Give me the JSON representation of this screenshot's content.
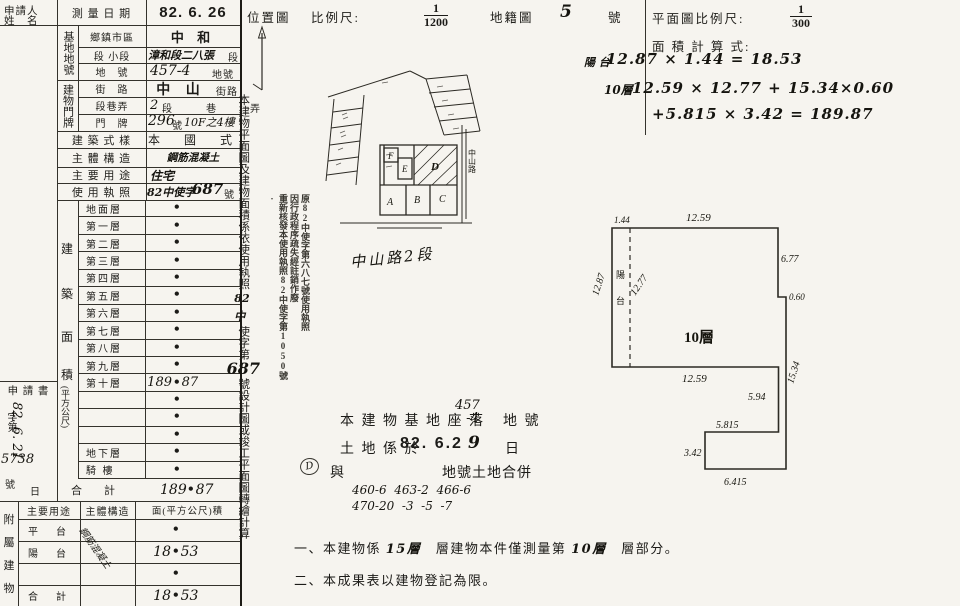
{
  "doc": {
    "bg": "#f6f4ef",
    "ink": "#1c1b18"
  },
  "left": {
    "applicant_l1": "申請人",
    "applicant_l2": "姓　名",
    "survey_label": "測 量 日 期",
    "survey_value": "82. 6. 26",
    "site_group": "基地地號",
    "site_rows": [
      {
        "label": "鄉鎮市區",
        "value": "中 和",
        "suffix": ""
      },
      {
        "label": "段 小段",
        "value": "漳和段二八張",
        "suffix": "段"
      },
      {
        "label": "地　號",
        "value": "457-4",
        "suffix": "地號"
      }
    ],
    "addr_group": "建物門牌",
    "addr_rows": [
      {
        "label": "街　路",
        "value": "中 山",
        "suffix": "街路"
      },
      {
        "label": "段巷弄",
        "value": "2",
        "suffix": "段　巷　弄"
      },
      {
        "label": "門　牌",
        "value": "296",
        "suffix": "號",
        "extra": "10F之4樓"
      }
    ],
    "style_label": "建 築 式 樣",
    "style_value": "本　國　式",
    "structure_label": "主 體 構 造",
    "structure_value": "鋼筋混凝土",
    "usage_label": "主 要 用 途",
    "usage_value": "住宅",
    "license_label": "使 用 執 照",
    "license_prefix": "82中使字",
    "license_num": "687",
    "license_suffix": "號",
    "floors": {
      "group_chars": [
        "建",
        "築",
        "面",
        "積"
      ],
      "unit": "(平方公尺)",
      "dot": "•",
      "rows": [
        {
          "label": "地面層",
          "l": "",
          "r": ""
        },
        {
          "label": "第一層",
          "l": "",
          "r": ""
        },
        {
          "label": "第二層",
          "l": "",
          "r": ""
        },
        {
          "label": "第三層",
          "l": "",
          "r": ""
        },
        {
          "label": "第四層",
          "l": "",
          "r": ""
        },
        {
          "label": "第五層",
          "l": "",
          "r": ""
        },
        {
          "label": "第六層",
          "l": "",
          "r": ""
        },
        {
          "label": "第七層",
          "l": "",
          "r": ""
        },
        {
          "label": "第八層",
          "l": "",
          "r": ""
        },
        {
          "label": "第九層",
          "l": "",
          "r": ""
        },
        {
          "label": "第十層",
          "l": "189",
          "r": "87"
        },
        {
          "label": "",
          "l": "",
          "r": ""
        },
        {
          "label": "",
          "l": "",
          "r": ""
        },
        {
          "label": "",
          "l": "",
          "r": ""
        },
        {
          "label": "地下層",
          "l": "",
          "r": ""
        },
        {
          "label": "騎 樓",
          "l": "",
          "r": ""
        }
      ],
      "total_label": "合　　計",
      "total_l": "189",
      "total_r": "87"
    },
    "application": {
      "label": "申 請 書",
      "zi": "字第",
      "num": "5738",
      "hao": "號",
      "date": "82. 6. 21",
      "day": "日"
    },
    "annex": {
      "group_chars": [
        "附",
        "屬",
        "建",
        "物"
      ],
      "headers": [
        "主要用途",
        "主體構造",
        "面(平方公尺)積"
      ],
      "rows": [
        {
          "use": "平　台",
          "l": "",
          "r": ""
        },
        {
          "use": "陽　台",
          "l": "18",
          "r": "53"
        },
        {
          "use": "",
          "l": "",
          "r": ""
        },
        {
          "use": "合　計",
          "l": "18",
          "r": "53"
        }
      ],
      "structure_note": "鋼筋混凝土"
    }
  },
  "mid": {
    "header": {
      "t1": "位置圖",
      "t2": "比例尺:",
      "num": "1",
      "den": "1200",
      "t3": "地籍圖",
      "hand": "5",
      "t4": "號"
    },
    "side_note": {
      "p1": "本建物平面圖及建物面積係依使用執照",
      "h1": "82中",
      "p2": "使字第",
      "h2": "687",
      "p3": "號設計圖或竣工平面圖轉繪計算"
    },
    "stamp": {
      "c1": "原82中使字第六八七號使用執照",
      "c2": "因行政程序疏失經註銷作廢",
      "c3": "重新核發本使用執照82中使字第1050號·"
    },
    "map": {
      "a": "A",
      "b": "B",
      "c": "C",
      "d": "D",
      "e": "E",
      "f": "F",
      "road_v": "中山路",
      "road_hand": "中山路2段"
    },
    "base_note": {
      "p1": "本 建 物 基 地 座 落",
      "v1": "457",
      "v2": "-4",
      "p2": "地 號",
      "p3": "土 地 係 於",
      "date": "82. 6.2",
      "date_h": "9",
      "p4": "日",
      "p5": "與",
      "h1": "460-6  463-2  466-6",
      "h2": "470-20  -3  -5  -7",
      "p6": "地號土地合併",
      "circle": "D"
    },
    "notes": {
      "n1a": "一、本建物係",
      "n1v1": "15層",
      "n1b": "層建物本件僅測量第",
      "n1v2": "10層",
      "n1c": "層部分。",
      "n2": "二、本成果表以建物登記為限。"
    }
  },
  "right": {
    "header": {
      "t1": "平面圖比例尺:",
      "num": "1",
      "den": "300"
    },
    "calc": {
      "title": "面 積 計 算 式:",
      "l1a": "陽 台",
      "l1b": "12.87 × 1.44 = 18.53",
      "l2a": "10層",
      "l2b": "12.59 × 12.77 + 15.34×0.60",
      "l3": "+5.815 × 3.42 = 189.87"
    },
    "plan": {
      "label": "10層",
      "balcony1": "陽",
      "balcony2": "台",
      "d_top_left": "1.44",
      "d_top": "12.59",
      "d_right": "6.77",
      "d_step": "0.60",
      "d_left": "12.87",
      "d_inner": "12.77",
      "d_bottom": "12.59",
      "d_strip": "15.34",
      "d_tail_r": "5.94",
      "d_tail_t": "5.815",
      "d_tail_l": "3.42",
      "d_tail_b": "6.415"
    }
  }
}
